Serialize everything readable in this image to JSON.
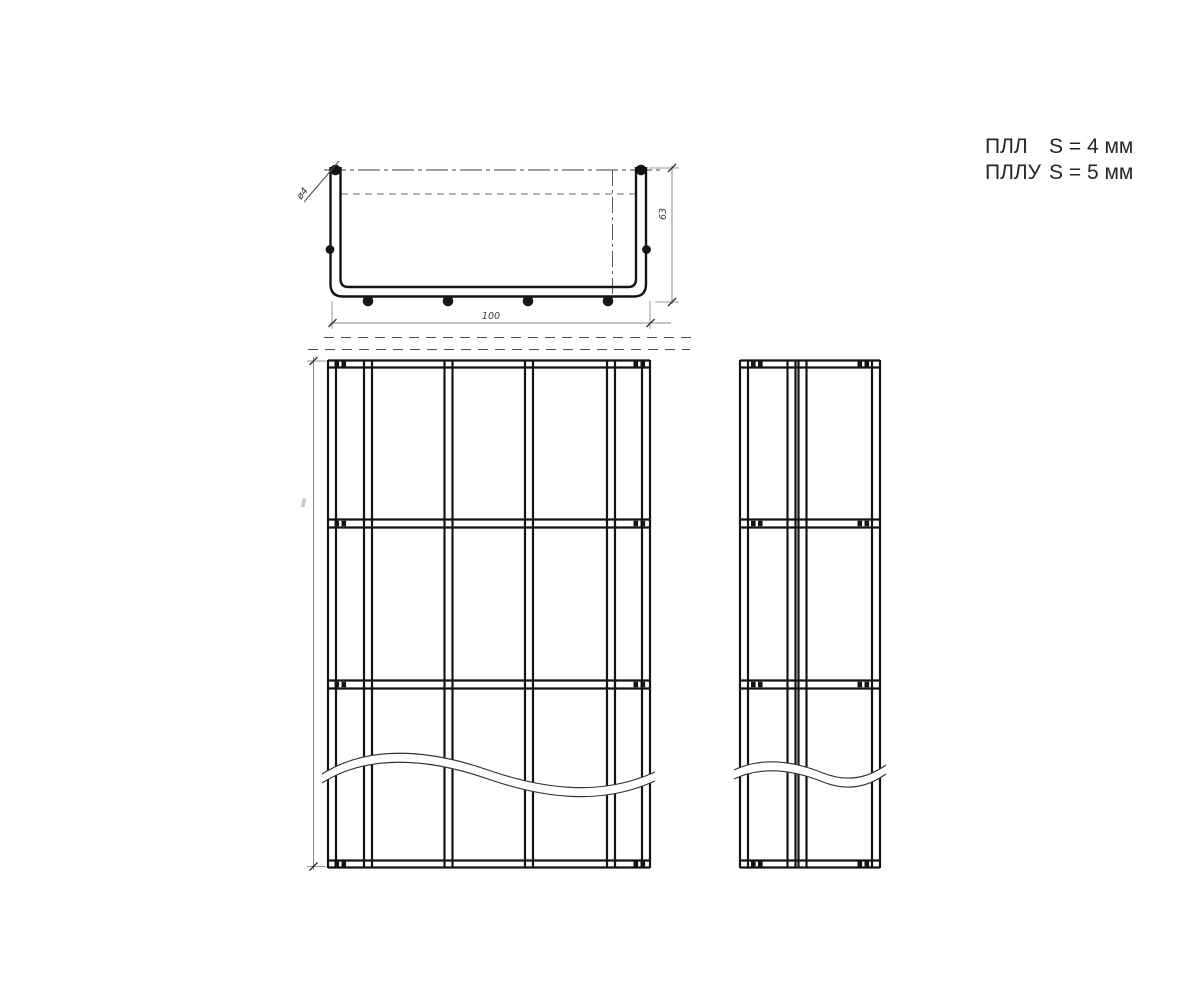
{
  "drawing": {
    "spec_table": [
      {
        "label": "ПЛЛ",
        "value": "S = 4 мм"
      },
      {
        "label": "ПЛЛУ",
        "value": "S = 5 мм"
      }
    ],
    "dimensions": {
      "tray_width": "100",
      "tray_height": "63",
      "wire_diameter": "ø4"
    },
    "colors": {
      "line": "#141414",
      "dimension": "#8a8a8a",
      "background": "#ffffff"
    }
  }
}
